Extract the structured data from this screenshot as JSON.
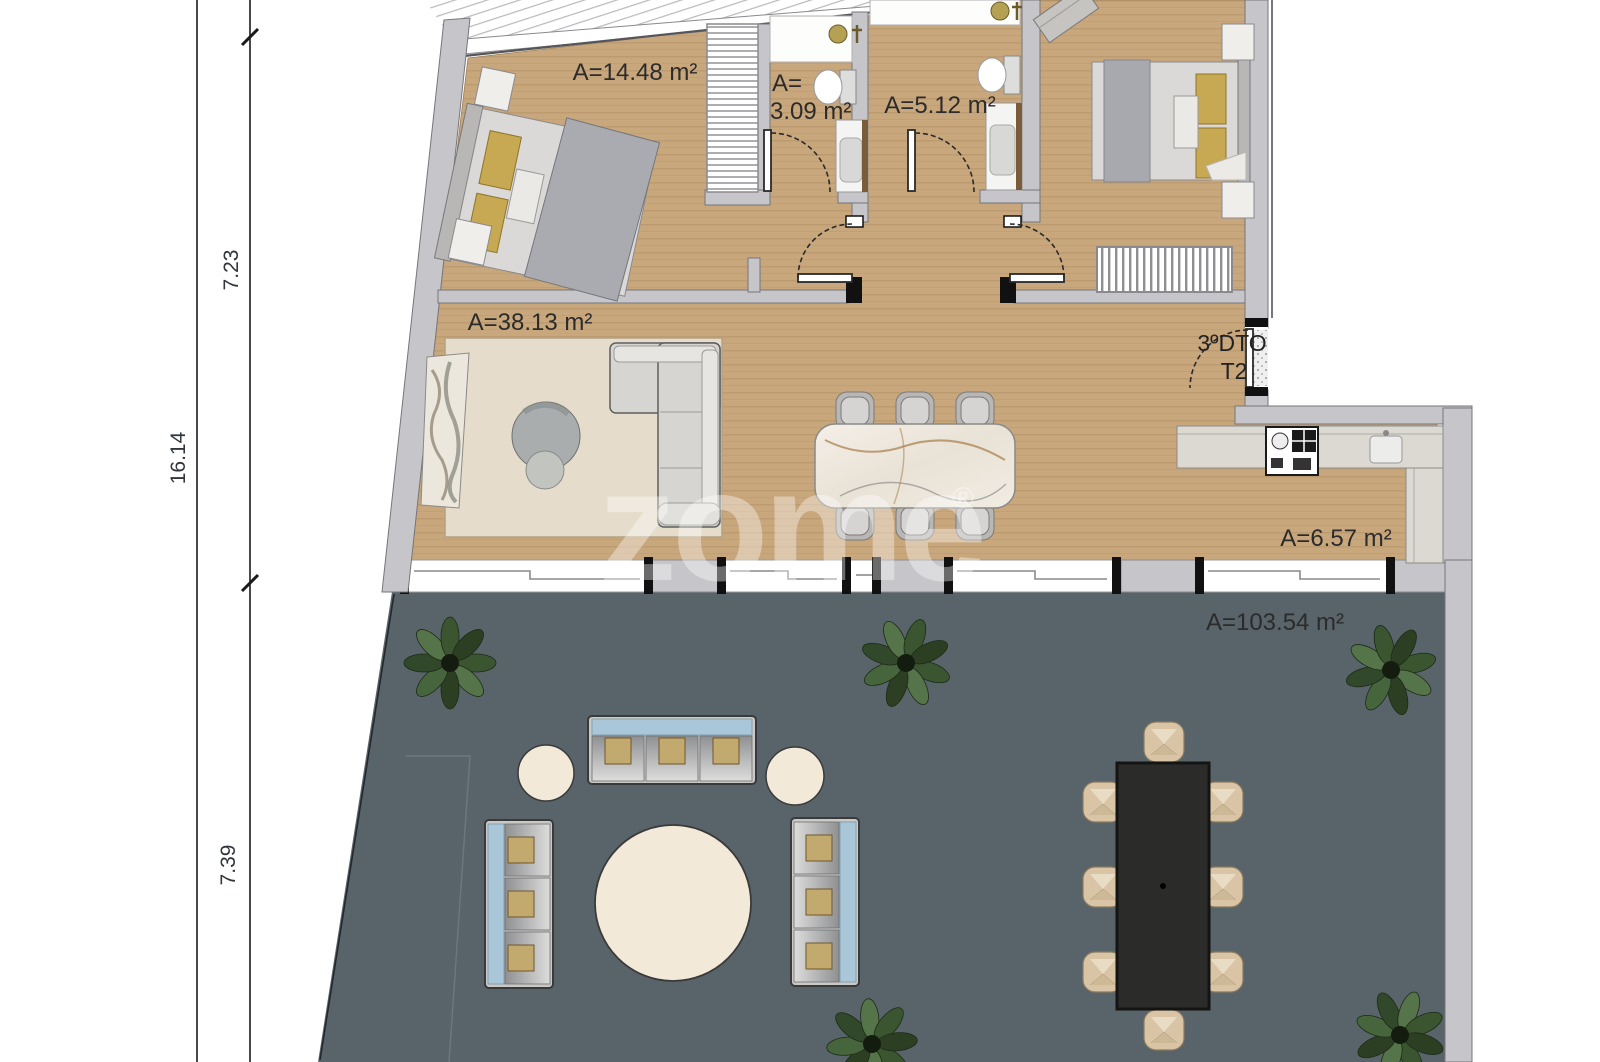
{
  "plan": {
    "title": "apartment-floor-plan",
    "unit": {
      "entry_line1": "3ºDTO",
      "entry_line2": "T2"
    },
    "rooms": {
      "bedroom1_area": "A=14.48 m²",
      "bathroom1_area_line1": "A=",
      "bathroom1_area_line2": "3.09 m²",
      "bathroom2_area": "A=5.12 m²",
      "living_area": "A=38.13 m²",
      "kitchen_area": "A=6.57 m²",
      "terrace_area": "A=103.54 m²"
    },
    "dimensions": {
      "total": "16.14",
      "upper": "7.23",
      "lower": "7.39"
    },
    "watermark": {
      "text": "zome",
      "reg": "®"
    },
    "colors": {
      "wood_floor": "#c8a77d",
      "wall_gray": "#c6c6ca",
      "terrace_gray": "#59646a",
      "sofa_blue": "#a9c7d8",
      "pillow_gold": "#c8a953",
      "outdoor_cream": "#f3e9d8",
      "plant_green": "#3c5531",
      "marble": "#efeae2",
      "outdoor_table_dark": "#2b2b29"
    }
  }
}
